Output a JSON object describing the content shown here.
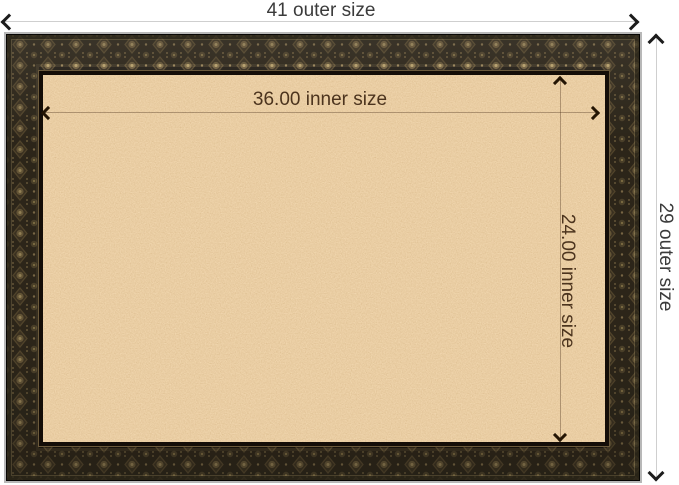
{
  "annotations": {
    "outer_width": {
      "label": "41 outer size"
    },
    "outer_height": {
      "label": "29 outer size"
    },
    "inner_width": {
      "label": "36.00 inner size"
    },
    "inner_height": {
      "label": "24.00 inner size"
    }
  },
  "icons": {
    "outer_width_left": "chevron-left",
    "outer_width_right": "chevron-right",
    "outer_height_up": "chevron-up",
    "outer_height_down": "chevron-down",
    "inner_width_left": "chevron-left",
    "inner_width_right": "chevron-right",
    "inner_height_up": "chevron-up",
    "inner_height_down": "chevron-down"
  },
  "colors": {
    "background": "#ffffff",
    "outer_label_text": "#3b3b3b",
    "inner_label_text": "#4c341e",
    "outer_dimension_line": "#cfcfcf",
    "inner_dimension_line": "rgba(77,50,28,0.38)",
    "arrowhead_outer": "#1c1c1c",
    "arrowhead_inner": "#241504",
    "cork_base": "#d79d63",
    "cork_highlight": "#ecbf8d",
    "cork_shadow": "#b57f49",
    "frame_base": "#1d1811",
    "frame_ornament": "#6f5d3c",
    "frame_ornament_highlight": "#b39c68",
    "frame_outer_edge": "#b8b8b8",
    "frame_keyline_bronze": "#6b5a3c"
  }
}
